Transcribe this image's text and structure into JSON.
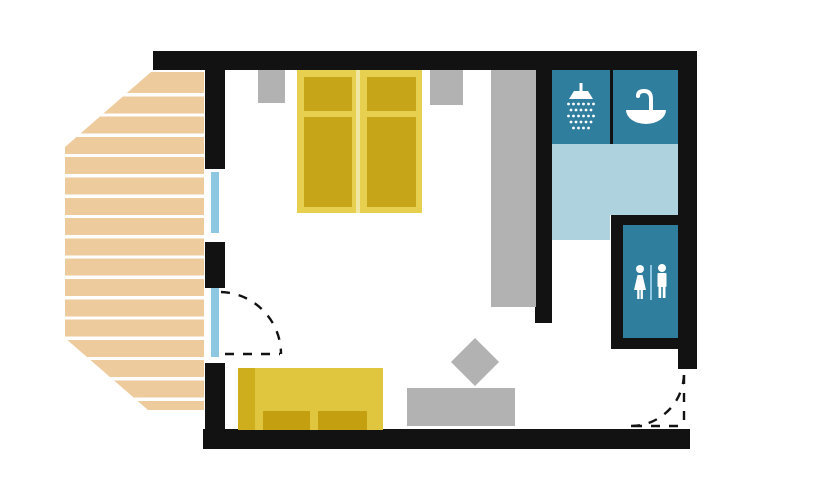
{
  "document": {
    "type": "floor-plan",
    "subject": "hotel room with terrace, bathroom and WC"
  },
  "palette": {
    "wall": "#121212",
    "room_bg": "#ffffff",
    "fixture_teal": "#2f7e9d",
    "bath_floor": "#aed3df",
    "glass_blue": "#8ec7e2",
    "terrace_wood": "#edcb9d",
    "furniture_gray": "#b2b2b2",
    "bed_frame": "#e7cf4f",
    "bed_mattress": "#c6a518",
    "bed_split": "#f0e7a3",
    "sofa_body": "#e0c63e",
    "sofa_arm": "#cfae1e",
    "sofa_cushion": "#c4a010",
    "icon_white": "#ffffff"
  },
  "areas": {
    "terrace": {
      "label": "Terrace deck"
    },
    "bedroom": {
      "label": "Bedroom and living area"
    },
    "bathroom": {
      "label": "Bathroom"
    },
    "wc": {
      "label": "WC"
    },
    "entry": {
      "label": "Entry"
    }
  },
  "furniture": {
    "double_bed": {
      "label": "Double bed with two mattresses"
    },
    "nightstand_left": {
      "label": "Nightstand left"
    },
    "nightstand_right": {
      "label": "Nightstand right"
    },
    "wardrobe": {
      "label": "Wardrobe"
    },
    "sofa": {
      "label": "Sofa"
    },
    "table": {
      "label": "Low table"
    },
    "side_table": {
      "label": "Side table (diamond)"
    },
    "shower": {
      "label": "Shower"
    },
    "sink": {
      "label": "Washbasin"
    },
    "toilet": {
      "label": "Toilet room"
    },
    "window": {
      "label": "Window"
    },
    "terrace_door": {
      "label": "Terrace door"
    },
    "entry_door": {
      "label": "Entry door"
    }
  }
}
